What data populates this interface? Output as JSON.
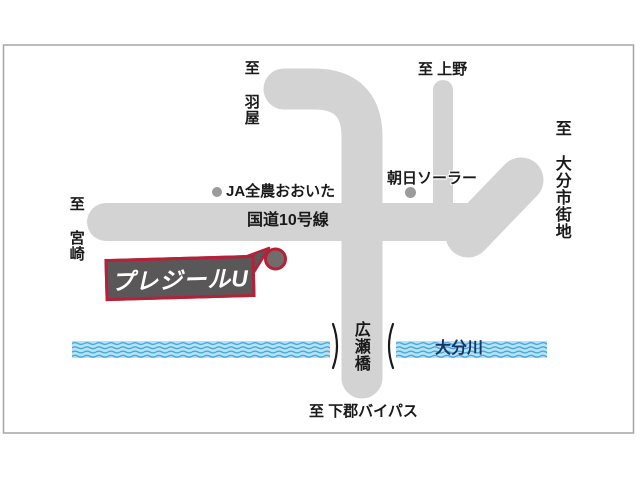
{
  "map": {
    "shop": {
      "name": "プレジールU"
    },
    "destinations": {
      "haneya": "至 羽屋",
      "ueno": "至 上野",
      "oita_downtown": "至 大分市街地",
      "miyazaki": "至 宮崎",
      "shimogori_bypass": "至 下郡バイパス"
    },
    "roads": {
      "route10": "国道10号線"
    },
    "landmarks": {
      "ja_zennoh_oita": "JA全農おおいた",
      "asahi_solar": "朝日ソーラー"
    },
    "bridge": {
      "name": "広瀬橋"
    },
    "river": {
      "name": "大分川"
    },
    "colors": {
      "road_gray": "#d3d3d4",
      "river_fill": "#b9e2f5",
      "river_wave": "#3aa4dc",
      "river_text": "#1b3264",
      "accent_red": "#b72038",
      "callout_gray": "#595757",
      "marker_gray": "#716d6c",
      "landmark_dot_gray": "#9b9b9b",
      "text_black": "#1a1a1a",
      "frame_gray": "#a5a5a7"
    }
  }
}
